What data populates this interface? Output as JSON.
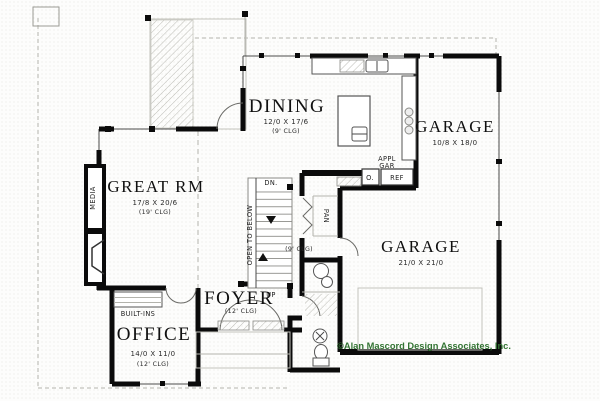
{
  "title": "First floor plan",
  "rooms": {
    "great": {
      "name": "GREAT RM",
      "dims": "17/8 X 20/6",
      "clg": "(19' CLG)"
    },
    "dining": {
      "name": "DINING",
      "dims": "12/0 X 17/6",
      "clg": "(9' CLG)"
    },
    "garage_upper": {
      "name": "GARAGE",
      "dims": "10/8 X 18/0"
    },
    "garage_main": {
      "name": "GARAGE",
      "dims": "21/0 X 21/0"
    },
    "office": {
      "name": "OFFICE",
      "dims": "14/0 X 11/0",
      "clg": "(12' CLG)"
    },
    "foyer": {
      "name": "FOYER",
      "clg": "(12' CLG)"
    }
  },
  "ann": {
    "media": "MEDIA",
    "pan": "PAN",
    "open_to_below": "OPEN TO BELOW",
    "built_ins": "BUILT-INS",
    "dn": "DN.",
    "up": "UP",
    "stair_clg": "(9' CLG)",
    "appl_line1": "APPL",
    "appl_line2": "GAR",
    "oven": "O.",
    "ref": "REF"
  },
  "footer": {
    "copyright": "©Alan Mascord Design Associates, Inc."
  },
  "colors": {
    "wall": "#0b0b0b",
    "thin_line": "#4a4a4a",
    "overhang_dash": "#b3b3ac",
    "copyright_green": "#337433"
  }
}
